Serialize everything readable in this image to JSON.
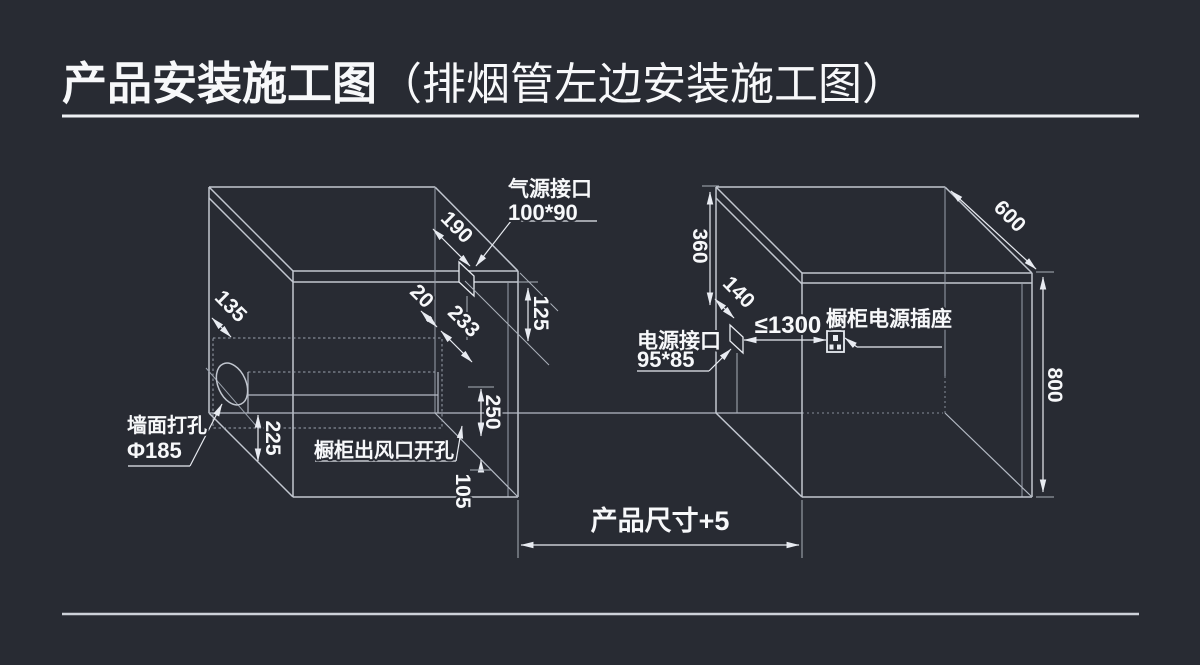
{
  "title": {
    "main": "产品安装施工图",
    "sub": "（排烟管左边安装施工图）"
  },
  "colors": {
    "background": "#282b33",
    "line": "#c2c7d0",
    "dim": "#e8ebf1",
    "text": "#f7f8fa"
  },
  "left_box": {
    "gas_port_label": {
      "line1": "气源接口",
      "line2": "100*90"
    },
    "wall_hole_label": {
      "line1": "墙面打孔",
      "line2": "Φ185"
    },
    "vent_label": "橱柜出风口开孔",
    "dims": {
      "top_depth": "190",
      "top_drop": "125",
      "front_gap": "20",
      "vent_depth": "233",
      "side_offset": "135",
      "vent_bottom_height": "225",
      "vent_height": "250",
      "bottom_gap": "105"
    }
  },
  "right_box": {
    "power_port_label": {
      "line1": "电源接口",
      "line2": "95*85"
    },
    "socket_label": "橱柜电源插座",
    "dims": {
      "port_top_offset": "360",
      "port_depth_offset": "140",
      "depth": "600",
      "height": "800",
      "socket_distance": "≤1300"
    }
  },
  "footer": {
    "product_size_label": "产品尺寸+5"
  }
}
